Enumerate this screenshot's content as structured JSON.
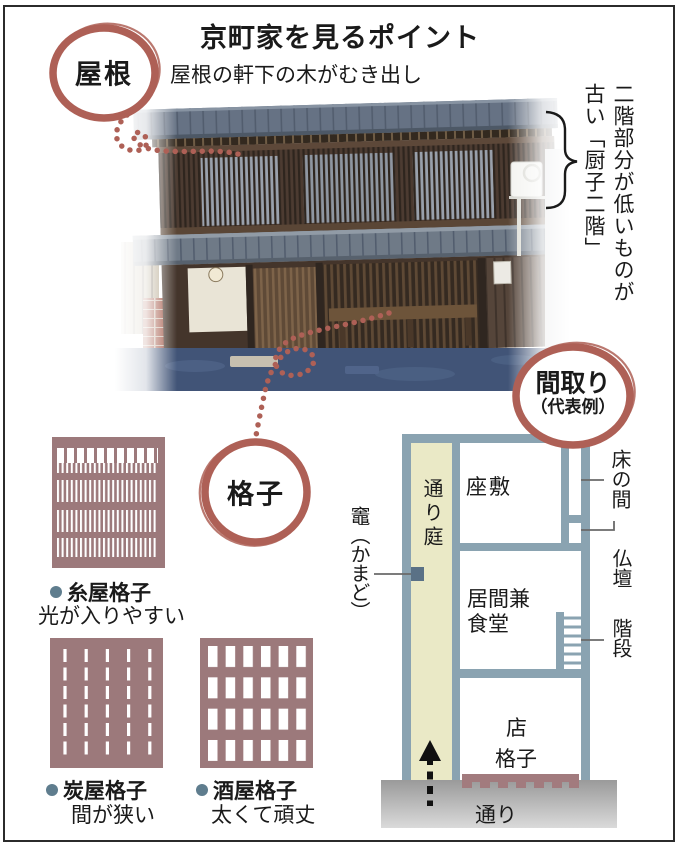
{
  "title": "京町家を見るポイント",
  "annotations": {
    "roof": {
      "label": "屋根",
      "note": "屋根の軒下の木がむき出し"
    },
    "second_floor": {
      "line1": "二階部分が低いものが",
      "line2": "古い「厨子二階」"
    },
    "koshi": {
      "label": "格子"
    },
    "madori": {
      "label": "間取り",
      "sublabel": "（代表例）"
    }
  },
  "floorplan": {
    "rooms": {
      "toriniwa": "通り庭",
      "zashiki": "座敷",
      "tokonoma": "床の間",
      "butsudan": "仏壇",
      "ima_line1": "居間兼",
      "ima_line2": "食堂",
      "kaidan": "階段",
      "mise": "店",
      "mise_koshi": "格子",
      "street": "通り",
      "kamado": "竈（かまど）"
    }
  },
  "lattices": [
    {
      "name": "糸屋格子",
      "desc": "光が入りやすい"
    },
    {
      "name": "炭屋格子",
      "desc": "間が狭い"
    },
    {
      "name": "酒屋格子",
      "desc": "太くて頑丈"
    }
  ],
  "colors": {
    "accent_red": "#ae6056",
    "wall_blue": "#8aa3b1",
    "lattice_mauve": "#9c797b",
    "toriniwa_yellow": "#eae9c6",
    "kamado_square": "#5a7186",
    "bullet_blue": "#5f7d8e"
  }
}
